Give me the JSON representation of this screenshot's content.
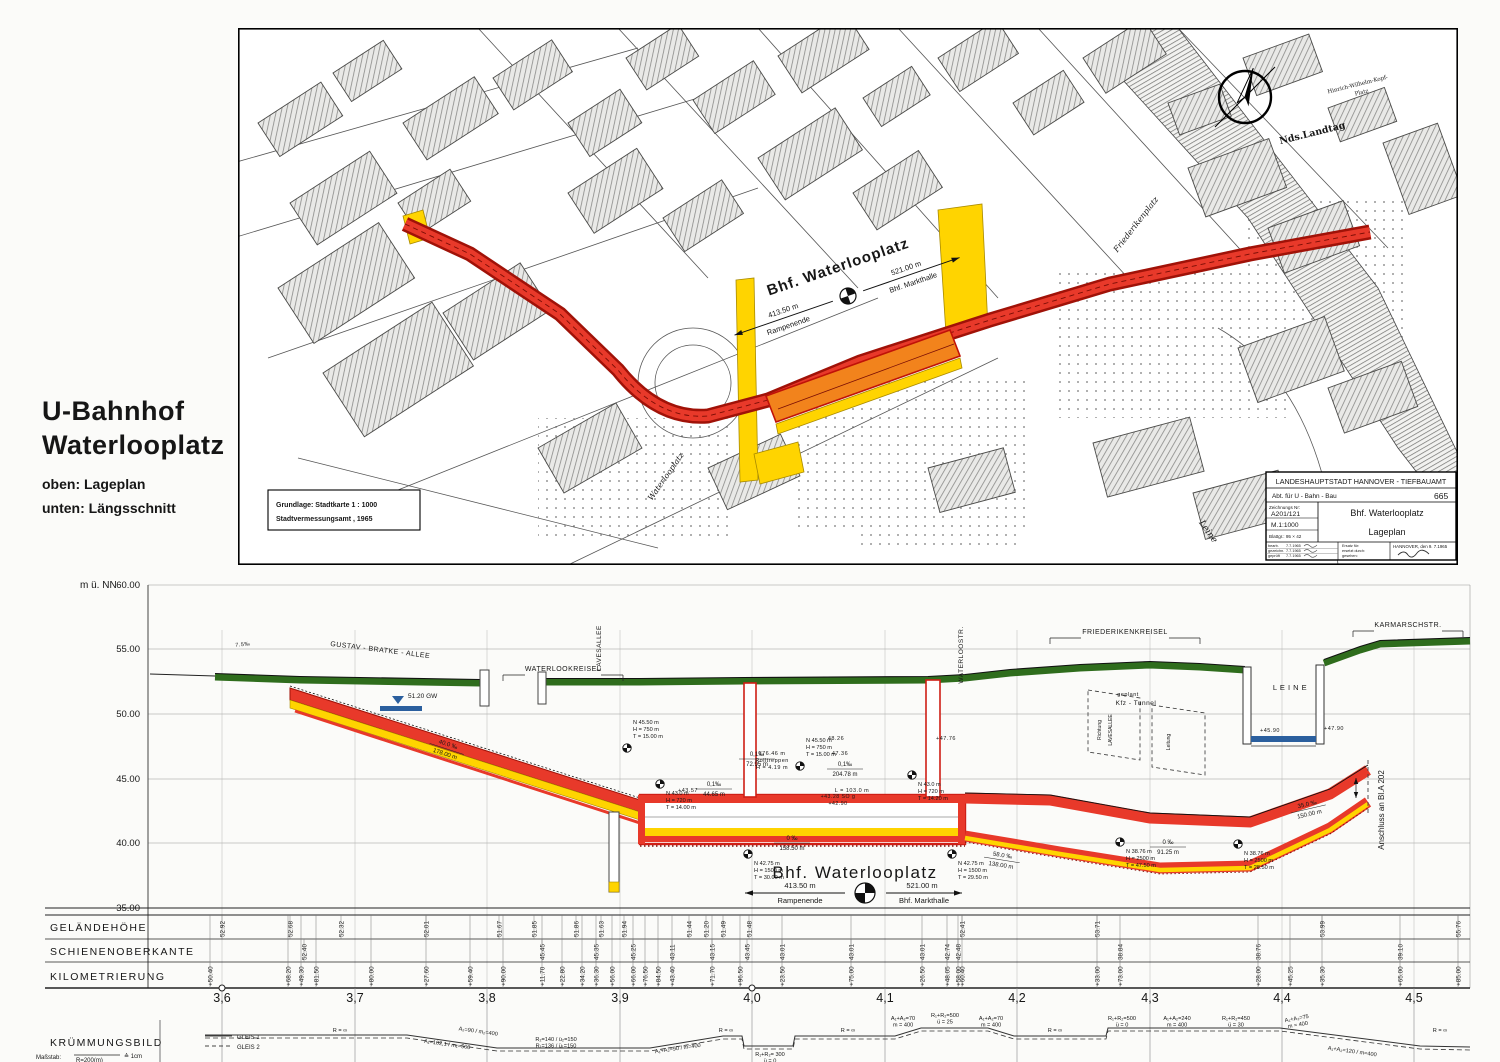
{
  "header": {
    "title_line1": "U-Bahnhof",
    "title_line2": "Waterlooplatz",
    "note_oben": "oben: Lageplan",
    "note_unten": "unten: Längsschnitt"
  },
  "map": {
    "source_note_line1": "Grundlage: Stadtkarte   1 : 1000",
    "source_note_line2": "Stadtvermessungsamt , 1965",
    "labels": {
      "friederikenplatz": "Friederikenplatz",
      "landtag": "Nds.Landtag",
      "kopfplatz1": "Hinrich-Wilhelm-Kopf-",
      "kopfplatz2": "Platz",
      "waterlooplatz_square": "Waterlooplatz",
      "leine": "Leine"
    },
    "title_block": {
      "line1": "LANDESHAUPTSTADT  HANNOVER - TIEFBAUAMT",
      "line2": "Abt. für U - Bahn - Bau",
      "dept_no": "665",
      "drawing_no_label": "Zeichnungs Nr:",
      "drawing_no": "A201/121",
      "scale": "M.1:1000",
      "sheet": "Blattgr.: 95 × 42",
      "title": "Bhf. Waterlooplatz",
      "subtitle": "Lageplan",
      "sig_rows": [
        [
          "bearb.",
          "7.7.1965"
        ],
        [
          "gezeichn.",
          "7.7.1965"
        ],
        [
          "geprüft",
          "7.7.1965"
        ]
      ],
      "replace_labels": [
        "Ersatz für:",
        "ersetzt durch:",
        "gesehen:"
      ],
      "place_date": "HANNOVER, den 9. 7.1965"
    }
  },
  "station_block": {
    "name": "Bhf. Waterlooplatz",
    "left_dist": "413.50 m",
    "left_dest": "Rampenende",
    "right_dist": "521.00 m",
    "right_dest": "Bhf. Markthalle"
  },
  "profile": {
    "unit": "m ü. NN",
    "row_labels": [
      "GELÄNDEHÖHE",
      "SCHIENENOBERKANTE",
      "KILOMETRIERUNG"
    ],
    "kruemmung_label": "KRÜMMUNGSBILD",
    "massstab_label": "Maßstab:",
    "massstab_denom": "R=200(m)",
    "massstab_eq": "≙ 1cm",
    "legend": [
      {
        "style": "solid",
        "label": "GLEIS 1"
      },
      {
        "style": "dashed",
        "label": "GLEIS 2"
      }
    ],
    "gw_label": "51.20 GW",
    "anschluss_label": "Anschluss an Bl.A 202",
    "elevation_ticks": [
      {
        "label": "60.00",
        "y": 15
      },
      {
        "label": "55.00",
        "y": 79
      },
      {
        "label": "50.00",
        "y": 144
      },
      {
        "label": "45.00",
        "y": 209
      },
      {
        "label": "40.00",
        "y": 273
      },
      {
        "label": "35.00",
        "y": 338
      }
    ],
    "km_ticks": [
      {
        "label": "3,6",
        "x": 222
      },
      {
        "label": "3,7",
        "x": 355
      },
      {
        "label": "3,8",
        "x": 487
      },
      {
        "label": "3,9",
        "x": 620
      },
      {
        "label": "4,0",
        "x": 752
      },
      {
        "label": "4,1",
        "x": 885
      },
      {
        "label": "4,2",
        "x": 1017
      },
      {
        "label": "4,3",
        "x": 1150
      },
      {
        "label": "4,4",
        "x": 1282
      },
      {
        "label": "4,5",
        "x": 1414
      }
    ],
    "gelaendehoehe": [
      {
        "x": 222,
        "v": "52.92"
      },
      {
        "x": 290,
        "v": "52.68"
      },
      {
        "x": 341,
        "v": "52.32"
      },
      {
        "x": 426,
        "v": "52.01"
      },
      {
        "x": 499,
        "v": "51.67"
      },
      {
        "x": 534,
        "v": "51.85"
      },
      {
        "x": 576,
        "v": "51.86"
      },
      {
        "x": 601,
        "v": "51.63"
      },
      {
        "x": 624,
        "v": "51.94"
      },
      {
        "x": 689,
        "v": "51.44"
      },
      {
        "x": 706,
        "v": "51.20"
      },
      {
        "x": 723,
        "v": "51.49"
      },
      {
        "x": 749,
        "v": "51.48"
      },
      {
        "x": 962,
        "v": "52.41"
      },
      {
        "x": 1097,
        "v": "53.71"
      },
      {
        "x": 1322,
        "v": "53.99"
      },
      {
        "x": 1458,
        "v": "55.76"
      }
    ],
    "schienenoberkante": [
      {
        "x": 304,
        "v": "52.40"
      },
      {
        "x": 542,
        "v": "45.45"
      },
      {
        "x": 596,
        "v": "45.35"
      },
      {
        "x": 633,
        "v": "45.25"
      },
      {
        "x": 672,
        "v": "43.11"
      },
      {
        "x": 712,
        "v": "43.15"
      },
      {
        "x": 747,
        "v": "43.45"
      },
      {
        "x": 782,
        "v": "43.01"
      },
      {
        "x": 851,
        "v": "43.01"
      },
      {
        "x": 922,
        "v": "43.01"
      },
      {
        "x": 947,
        "v": "42.74"
      },
      {
        "x": 958,
        "v": "42.48"
      },
      {
        "x": 1120,
        "v": "38.84"
      },
      {
        "x": 1258,
        "v": "38.76"
      },
      {
        "x": 1400,
        "v": "39.10"
      }
    ],
    "kilometrierung": [
      {
        "x": 210,
        "v": "+50.40"
      },
      {
        "x": 288,
        "v": "+68.20"
      },
      {
        "x": 301,
        "v": "+49.30"
      },
      {
        "x": 316,
        "v": "+81.50"
      },
      {
        "x": 371,
        "v": "+80.00"
      },
      {
        "x": 426,
        "v": "+27.60"
      },
      {
        "x": 470,
        "v": "+59.40"
      },
      {
        "x": 503,
        "v": "+90.00"
      },
      {
        "x": 542,
        "v": "+11.70"
      },
      {
        "x": 562,
        "v": "+22.80"
      },
      {
        "x": 582,
        "v": "+34.20"
      },
      {
        "x": 596,
        "v": "+36.30"
      },
      {
        "x": 612,
        "v": "+56.00"
      },
      {
        "x": 633,
        "v": "+66.00"
      },
      {
        "x": 645,
        "v": "+76.50"
      },
      {
        "x": 658,
        "v": "+84.50"
      },
      {
        "x": 672,
        "v": "+43.40"
      },
      {
        "x": 712,
        "v": "+71.70"
      },
      {
        "x": 740,
        "v": "+96.50"
      },
      {
        "x": 782,
        "v": "+23.50"
      },
      {
        "x": 851,
        "v": "+75.00"
      },
      {
        "x": 922,
        "v": "+26.50"
      },
      {
        "x": 947,
        "v": "+48.05"
      },
      {
        "x": 958,
        "v": "+58.00"
      },
      {
        "x": 962,
        "v": "+60.40"
      },
      {
        "x": 1097,
        "v": "+33.00"
      },
      {
        "x": 1120,
        "v": "+73.00"
      },
      {
        "x": 1258,
        "v": "+28.00"
      },
      {
        "x": 1290,
        "v": "+45.25"
      },
      {
        "x": 1322,
        "v": "+35.30"
      },
      {
        "x": 1400,
        "v": "+65.00"
      },
      {
        "x": 1458,
        "v": "+85.00"
      }
    ],
    "street_labels": [
      {
        "text": "7.5‰",
        "x": 243,
        "y": 76,
        "rot": -6,
        "size": 5.5
      },
      {
        "text": "GUSTAV - BRATKE - ALLEE",
        "x": 380,
        "y": 82,
        "rot": 7,
        "size": 7
      },
      {
        "text": "WATERLOOKREISEL",
        "x": 563,
        "y": 101,
        "rot": 0,
        "size": 7,
        "bracket": 120
      },
      {
        "text": "LAVESALLEE",
        "x": 601,
        "y": 78,
        "rot": -90,
        "size": 6.5
      },
      {
        "text": "WATERLOOSTR.",
        "x": 963,
        "y": 85,
        "rot": -90,
        "size": 6.5
      },
      {
        "text": "FRIEDERIKENKREISEL",
        "x": 1125,
        "y": 64,
        "rot": 0,
        "size": 7,
        "bracket": 150
      },
      {
        "text": "geplant",
        "x": 1128,
        "y": 126,
        "rot": 0,
        "size": 5.5
      },
      {
        "text": "Kfz - Tunnel",
        "x": 1136,
        "y": 135,
        "rot": 0,
        "size": 6.5
      },
      {
        "text": "L E I N E",
        "x": 1290,
        "y": 120,
        "rot": 0,
        "size": 7.5
      },
      {
        "text": "KARMARSCHSTR.",
        "x": 1408,
        "y": 57,
        "rot": 0,
        "size": 7,
        "bracket": 110
      },
      {
        "text": "+45.90",
        "x": 1270,
        "y": 162,
        "rot": 0,
        "size": 5.5
      },
      {
        "text": "+47.90",
        "x": 1334,
        "y": 160,
        "rot": 0,
        "size": 5.5
      },
      {
        "text": "Rolltreppen",
        "x": 772,
        "y": 192,
        "rot": 0,
        "size": 5.5
      },
      {
        "text": "H = 4.19 m",
        "x": 772,
        "y": 199,
        "rot": 0,
        "size": 5.5
      },
      {
        "text": "176.46 m",
        "x": 772,
        "y": 185,
        "rot": 0,
        "size": 5.5
      },
      {
        "text": "48.26",
        "x": 836,
        "y": 170,
        "rot": 0,
        "size": 5.5
      },
      {
        "text": "47.36",
        "x": 840,
        "y": 185,
        "rot": 0,
        "size": 5.5
      },
      {
        "text": "+47.76",
        "x": 946,
        "y": 170,
        "rot": 0,
        "size": 5.5
      },
      {
        "text": "L = 103.0 m",
        "x": 852,
        "y": 222,
        "rot": 0,
        "size": 5.5
      },
      {
        "text": "+43.57",
        "x": 688,
        "y": 222,
        "rot": 0,
        "size": 5.5
      },
      {
        "text": "+43.28 SO g",
        "x": 838,
        "y": 228,
        "rot": 0,
        "size": 5.2
      },
      {
        "text": "+42.90",
        "x": 838,
        "y": 235,
        "rot": 0,
        "size": 5.2
      }
    ],
    "curve_points": [
      {
        "x": 627,
        "y": 178,
        "below": false,
        "lines": [
          "N 45.50 m",
          "H =  750 m",
          "T = 15.00 m"
        ]
      },
      {
        "x": 800,
        "y": 196,
        "below": false,
        "lines": [
          "N 45.50 m",
          "H =  750 m",
          "T = 15.00 m"
        ]
      },
      {
        "x": 660,
        "y": 214,
        "below": true,
        "lines": [
          "N 43.0 m",
          "H =  720 m",
          "T = 14.00 m"
        ]
      },
      {
        "x": 912,
        "y": 205,
        "below": true,
        "lines": [
          "N 43.0 m",
          "H =  720 m",
          "T = 14.20 m"
        ]
      },
      {
        "x": 748,
        "y": 284,
        "below": true,
        "lines": [
          "N 42.75 m",
          "H = 1500 m",
          "T = 30.00 m"
        ]
      },
      {
        "x": 952,
        "y": 284,
        "below": true,
        "lines": [
          "N 42.75 m",
          "H = 1500 m",
          "T = 29.50 m"
        ]
      },
      {
        "x": 1120,
        "y": 272,
        "below": true,
        "lines": [
          "N 38.76 m",
          "H = 2500 m",
          "T = 47.50 m"
        ]
      },
      {
        "x": 1238,
        "y": 274,
        "below": true,
        "lines": [
          "N 38.76 m",
          "H = 2500 m",
          "T = 28.50 m"
        ]
      }
    ],
    "slope_labels": [
      {
        "x": 447,
        "y": 178,
        "rot": 18,
        "top": "40.0 ‰",
        "bot": "178.00 m"
      },
      {
        "x": 757,
        "y": 188,
        "rot": 0,
        "top": "0,1‰",
        "bot": "72.95 m"
      },
      {
        "x": 714,
        "y": 218,
        "rot": 0,
        "top": "0,1‰",
        "bot": "44.65 m"
      },
      {
        "x": 845,
        "y": 198,
        "rot": 0,
        "top": "0,1‰",
        "bot": "204.78 m"
      },
      {
        "x": 792,
        "y": 272,
        "rot": 0,
        "top": "0 ‰",
        "bot": "158.50 m"
      },
      {
        "x": 1168,
        "y": 276,
        "rot": 0,
        "top": "0 ‰",
        "bot": "91.25 m"
      },
      {
        "x": 1002,
        "y": 289,
        "rot": 9,
        "top": "58.0 ‰",
        "bot": "138.00 m"
      },
      {
        "x": 1308,
        "y": 238,
        "rot": -13,
        "top": "35.0 ‰",
        "bot": "150.00 m"
      }
    ],
    "richtung_labels": [
      {
        "text": "Richtung",
        "x": 1101,
        "y": 160
      },
      {
        "text": "LAVESALLEE",
        "x": 1112,
        "y": 160
      },
      {
        "text": "Leitung",
        "x": 1170,
        "y": 172
      }
    ],
    "curve_labels": [
      {
        "x": 340,
        "y": 462,
        "rot": 0,
        "lines": [
          "R = ∞"
        ]
      },
      {
        "x": 447,
        "y": 476,
        "rot": 8,
        "lines": [
          "A₁=102,1  /  m₁=500"
        ]
      },
      {
        "x": 478,
        "y": 463,
        "rot": 8,
        "lines": [
          "A₂=90 / m₂=400"
        ]
      },
      {
        "x": 556,
        "y": 471,
        "rot": 0,
        "lines": [
          "R₂=140  /  ü₂=150",
          "R₁=136  /  ü₁=150"
        ]
      },
      {
        "x": 678,
        "y": 480,
        "rot": -8,
        "lines": [
          "A₁+A₂=90 /  m=400"
        ]
      },
      {
        "x": 726,
        "y": 462,
        "rot": 0,
        "lines": [
          "R = ∞"
        ]
      },
      {
        "x": 770,
        "y": 486,
        "rot": 0,
        "lines": [
          "R₁+R₂= 300",
          "ü = 0"
        ]
      },
      {
        "x": 848,
        "y": 462,
        "rot": 0,
        "lines": [
          "R = ∞"
        ]
      },
      {
        "x": 903,
        "y": 450,
        "rot": 0,
        "lines": [
          "A₁+A₂=70",
          "m = 400"
        ]
      },
      {
        "x": 945,
        "y": 447,
        "rot": 0,
        "lines": [
          "R₁+R₂=500",
          "ü = 25"
        ]
      },
      {
        "x": 991,
        "y": 450,
        "rot": 0,
        "lines": [
          "A₁+A₂=70",
          "m = 400"
        ]
      },
      {
        "x": 1055,
        "y": 462,
        "rot": 0,
        "lines": [
          "R = ∞"
        ]
      },
      {
        "x": 1122,
        "y": 450,
        "rot": 0,
        "lines": [
          "R₁+R₂=500",
          "ü = 0"
        ]
      },
      {
        "x": 1177,
        "y": 450,
        "rot": 0,
        "lines": [
          "A₁+A₂=240",
          "m = 400"
        ]
      },
      {
        "x": 1236,
        "y": 450,
        "rot": 0,
        "lines": [
          "R₁+R₂=450",
          "ü = 30"
        ]
      },
      {
        "x": 1297,
        "y": 450,
        "rot": -10,
        "lines": [
          "A₁+A₂=75",
          "m = 400"
        ]
      },
      {
        "x": 1352,
        "y": 483,
        "rot": 8,
        "lines": [
          "A₁+A₂=120 / m=400"
        ]
      },
      {
        "x": 1440,
        "y": 462,
        "rot": 0,
        "lines": [
          "R = ∞"
        ]
      }
    ]
  },
  "chart_data": {
    "type": "line",
    "title": "Längsschnitt Bhf. Waterlooplatz",
    "xlabel": "Kilometrierung (km)",
    "ylabel": "m ü. NN",
    "xlim": [
      3.55,
      4.55
    ],
    "ylim": [
      35,
      60
    ],
    "x_ticks": [
      3.6,
      3.7,
      3.8,
      3.9,
      4.0,
      4.1,
      4.2,
      4.3,
      4.4,
      4.5
    ],
    "series": [
      {
        "name": "Gelände",
        "x": [
          3.6,
          3.65,
          3.7,
          3.8,
          3.9,
          3.95,
          4.0,
          4.05,
          4.16,
          4.25,
          4.3,
          4.34,
          4.4,
          4.45,
          4.5
        ],
        "y": [
          52.92,
          52.68,
          52.32,
          52.01,
          51.67,
          51.44,
          51.48,
          52.41,
          52.4,
          53.71,
          53.8,
          47.9,
          53.99,
          55.76,
          55.76
        ]
      },
      {
        "name": "Schienenoberkante",
        "x": [
          3.66,
          3.68,
          3.8,
          3.89,
          3.93,
          3.96,
          4.0,
          4.07,
          4.13,
          4.16,
          4.25,
          4.3,
          4.4,
          4.46,
          4.5
        ],
        "y": [
          52.4,
          52.0,
          46.9,
          45.45,
          45.25,
          43.45,
          43.01,
          43.01,
          43.01,
          42.48,
          40.2,
          38.84,
          38.76,
          40.2,
          41.0
        ]
      }
    ],
    "annotations": [
      "Bhf. Waterlooplatz — 413.50 m bis Rampenende, 521.00 m bis Bhf. Markthalle",
      "Gefälle 40.0 ‰ auf 178.00 m",
      "0 ‰ auf 158.50 m",
      "35.0 ‰ auf 150.00 m"
    ],
    "legend_position": "bottom-left",
    "grid": true
  }
}
